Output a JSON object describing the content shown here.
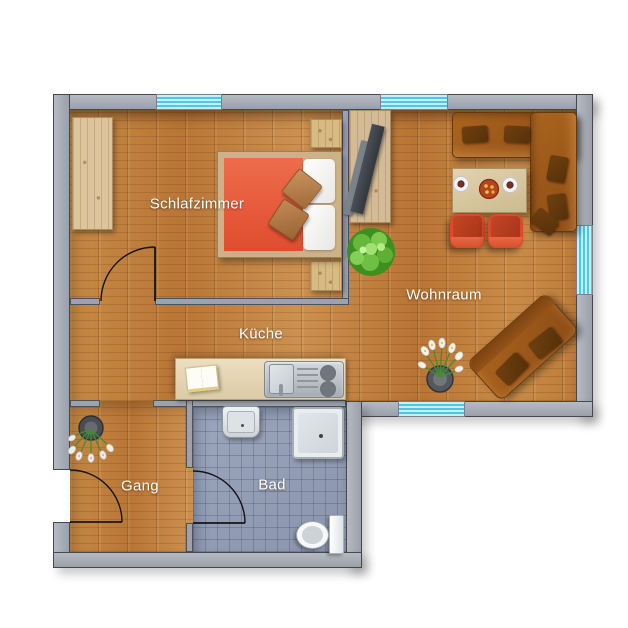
{
  "floorplan": {
    "view": "apartment-top-down-floor-plan",
    "rooms": {
      "schlafzimmer": {
        "label": "Schlafzimmer"
      },
      "wohnraum": {
        "label": "Wohnraum"
      },
      "kueche": {
        "label": "Küche"
      },
      "gang": {
        "label": "Gang"
      },
      "bad": {
        "label": "Bad"
      }
    },
    "furniture": {
      "schlafzimmer": [
        "wardrobe",
        "double-bed-with-orange-cover",
        "nightstand-top",
        "nightstand-bottom",
        "two-cushions"
      ],
      "wohnraum": [
        "sideboard-with-tv",
        "potted-plant",
        "corner-sofa-brown",
        "dining-table-with-two-place-settings-and-bowl",
        "armchair-left",
        "armchair-right",
        "diagonal-sofa",
        "floor-vase-with-flowers"
      ],
      "kueche": [
        "kitchen-counter",
        "open-cookbook",
        "sink-with-faucet",
        "two-burner-stove"
      ],
      "gang": [
        "floor-vase-with-flowers"
      ],
      "bad": [
        "washbasin",
        "shower",
        "toilet"
      ]
    },
    "openings": {
      "windows": [
        "top-wall-bedroom",
        "top-wall-livingroom",
        "right-wall-livingroom",
        "bottom-wall-livingroom"
      ],
      "doors": [
        "entry-door-left-wall",
        "bedroom-door",
        "bathroom-door"
      ],
      "passage": "gang-to-kueche-opening"
    },
    "colors": {
      "wall_fill": "#a3a8b1",
      "wall_outline": "#45494f",
      "wood_floor": "#bf7f3e",
      "bath_tiles": "#939db4",
      "window_glass": "#4fc6e8",
      "bed_cover": "#e65639",
      "armchair": "#d94c2b",
      "sofa_brown": "#9c5a1d",
      "label_text": "#ffffff",
      "background": "#ffffff"
    }
  }
}
